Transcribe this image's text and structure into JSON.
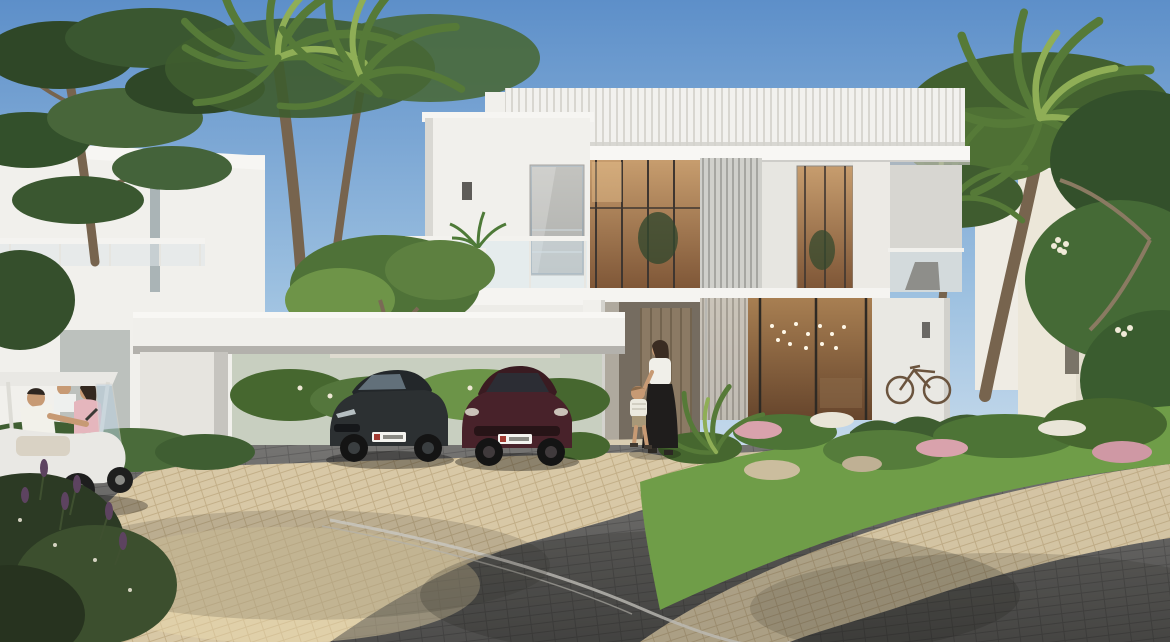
{
  "scene": {
    "type": "architectural-exterior-render",
    "description": "Sunny real-estate rendering of a modern two-storey white villa with louvred parapet, vertical screen panels and warm floor-to-ceiling glazing; a white portal-frame carport shelters a dark grey sedan and a dark red SUV; palm trees and lush flowering gardens surround a curved grey block-paved street with sand-coloured driveway; a mother and child walk to the entrance while neighbours chat at a white golf buggy.",
    "house_number": "17",
    "weather": "clear blue sky",
    "objects": [
      {
        "name": "main-villa",
        "label": "Two-storey white modern villa with louvre screens and warm interior light"
      },
      {
        "name": "carport",
        "label": "White portal-frame carport"
      },
      {
        "name": "sedan-car",
        "label": "Dark grey sedan with white licence plate"
      },
      {
        "name": "suv-car",
        "label": "Dark red SUV with white licence plate"
      },
      {
        "name": "golf-cart",
        "label": "White golf buggy with driver and two neighbours"
      },
      {
        "name": "woman-and-child",
        "label": "Mother holding a child's hand at the front steps"
      },
      {
        "name": "bicycle",
        "label": "Bicycle leaning on the wall behind the hedge"
      },
      {
        "name": "palm-trees",
        "label": "Tall date palms framing the scene"
      },
      {
        "name": "garden",
        "label": "Lawn, hedges and pink/white flowering shrubs"
      },
      {
        "name": "street",
        "label": "Curved dark paver road with white kerb line and sand pavement"
      },
      {
        "name": "neighbour-villa-left",
        "label": "White neighbouring villa behind pine and palms"
      },
      {
        "name": "neighbour-villa-right",
        "label": "Beige neighbouring villa behind palms"
      }
    ],
    "palette": {
      "sky_top": "#5d8fc9",
      "sky_horizon": "#d6e4f0",
      "villa_white": "#f1f0ec",
      "villa_shadow": "#d9d8d3",
      "glass_warm": "#b08255",
      "glass_cool": "#9fb0bc",
      "louver_gray": "#cfcfca",
      "road_dark": "#757472",
      "paver_sand": "#d8c8a6",
      "grass": "#6f9d48",
      "shrub": "#46672f",
      "tree_dark": "#2f4727",
      "palm_green": "#567a38",
      "palm_light": "#8fae56",
      "trunk": "#77644e",
      "sedan": "#2c3032",
      "suv": "#48222a",
      "cart_white": "#e9e8e4",
      "skin": "#c79a74",
      "flower_pink": "#d9a2ac",
      "flower_purple": "#5d4360"
    }
  }
}
